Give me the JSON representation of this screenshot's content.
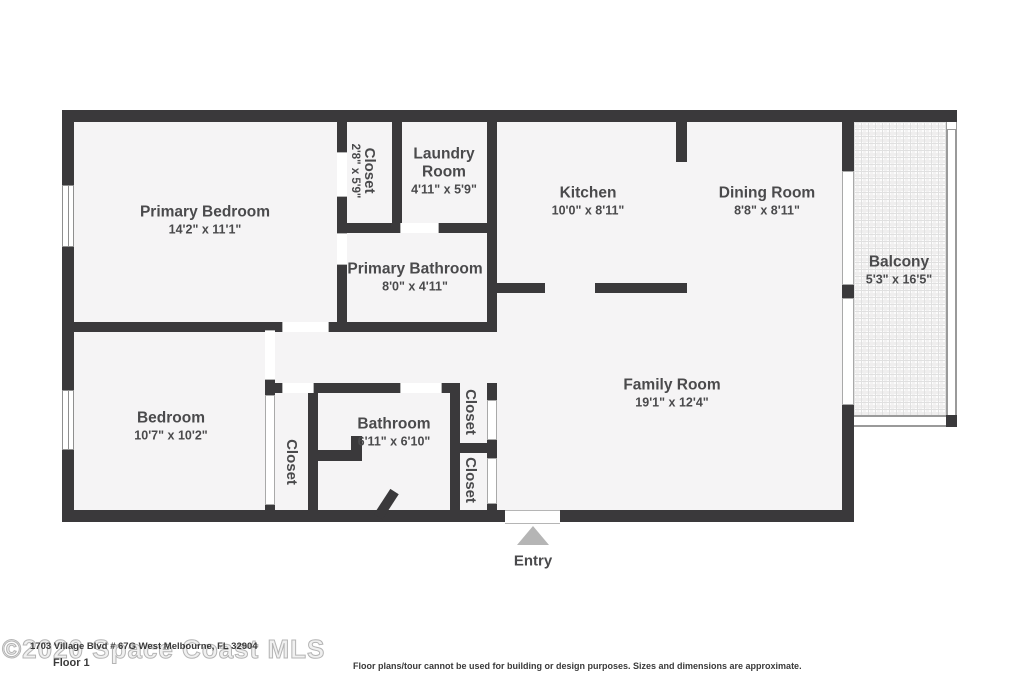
{
  "plan": {
    "rooms": {
      "primary_bedroom": {
        "name": "Primary Bedroom",
        "dims": "14'2\" x 11'1\""
      },
      "closet_primary": {
        "name": "Closet",
        "dims": "2'8\" x 5'9\""
      },
      "laundry": {
        "name": "Laundry Room",
        "dims": "4'11\" x 5'9\""
      },
      "kitchen": {
        "name": "Kitchen",
        "dims": "10'0\" x 8'11\""
      },
      "dining": {
        "name": "Dining Room",
        "dims": "8'8\" x 8'11\""
      },
      "balcony": {
        "name": "Balcony",
        "dims": "5'3\" x 16'5\""
      },
      "primary_bathroom": {
        "name": "Primary Bathroom",
        "dims": "8'0\" x 4'11\""
      },
      "family": {
        "name": "Family Room",
        "dims": "19'1\" x 12'4\""
      },
      "bedroom": {
        "name": "Bedroom",
        "dims": "10'7\" x 10'2\""
      },
      "bathroom": {
        "name": "Bathroom",
        "dims": "6'11\" x 6'10\""
      },
      "closet_bedroom": {
        "name": "Closet"
      },
      "closet_hall_top": {
        "name": "Closet"
      },
      "closet_hall_bottom": {
        "name": "Closet"
      }
    },
    "entry_label": "Entry"
  },
  "footer": {
    "watermark": "©2020 Space Coast MLS",
    "address": "1703 Village Blvd # 67G West Melbourne, FL 32904",
    "floor_label": "Floor 1",
    "disclaimer": "Floor plans/tour cannot be used for building or design purposes. Sizes and dimensions are approximate."
  },
  "colors": {
    "wall": "#3a393b",
    "room_fill": "#f5f4f5",
    "label_text": "#4a4a4c",
    "entry_triangle": "#b5b5b5",
    "balcony_tile_line": "#e0e0e0"
  }
}
